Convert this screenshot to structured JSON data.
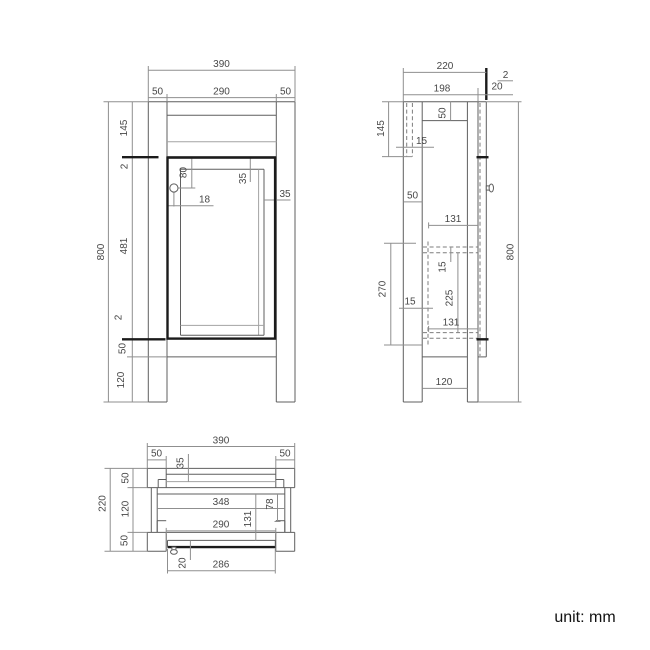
{
  "unit_label": "unit: mm",
  "views": {
    "front": {
      "dims": {
        "total_width": "390",
        "left_post": "50",
        "opening_width": "290",
        "right_post": "50",
        "total_height": "800",
        "top_section": "145",
        "top_gap": "2",
        "door_height": "481",
        "bottom_gap": "2",
        "bottom_rail": "50",
        "leg_height": "120",
        "handle_from_top": "80",
        "frame_top": "35",
        "frame_side": "35",
        "handle_inset": "18"
      }
    },
    "side": {
      "dims": {
        "total_depth": "220",
        "body_depth": "198",
        "door_gap": "2",
        "door_thickness": "20",
        "top_section": "145",
        "back_panel": "15",
        "top_rail_depth": "50",
        "leg_depth": "50",
        "shelf_depth_upper": "131",
        "shelf_thickness": "15",
        "shelf_gap": "225",
        "shelf_depth_lower": "131",
        "interior_height": "270",
        "side_panel": "15",
        "total_height": "800",
        "leg_spacing": "120"
      }
    },
    "top": {
      "dims": {
        "total_width": "390",
        "left_leg": "50",
        "right_leg": "50",
        "back_rail": "35",
        "total_depth": "220",
        "back_leg_depth": "50",
        "middle_depth": "120",
        "front_leg_depth": "50",
        "interior_width": "348",
        "runner_depth": "78",
        "interior_depth": "131",
        "opening_width": "290",
        "door_thickness": "20",
        "door_width": "286"
      }
    }
  }
}
